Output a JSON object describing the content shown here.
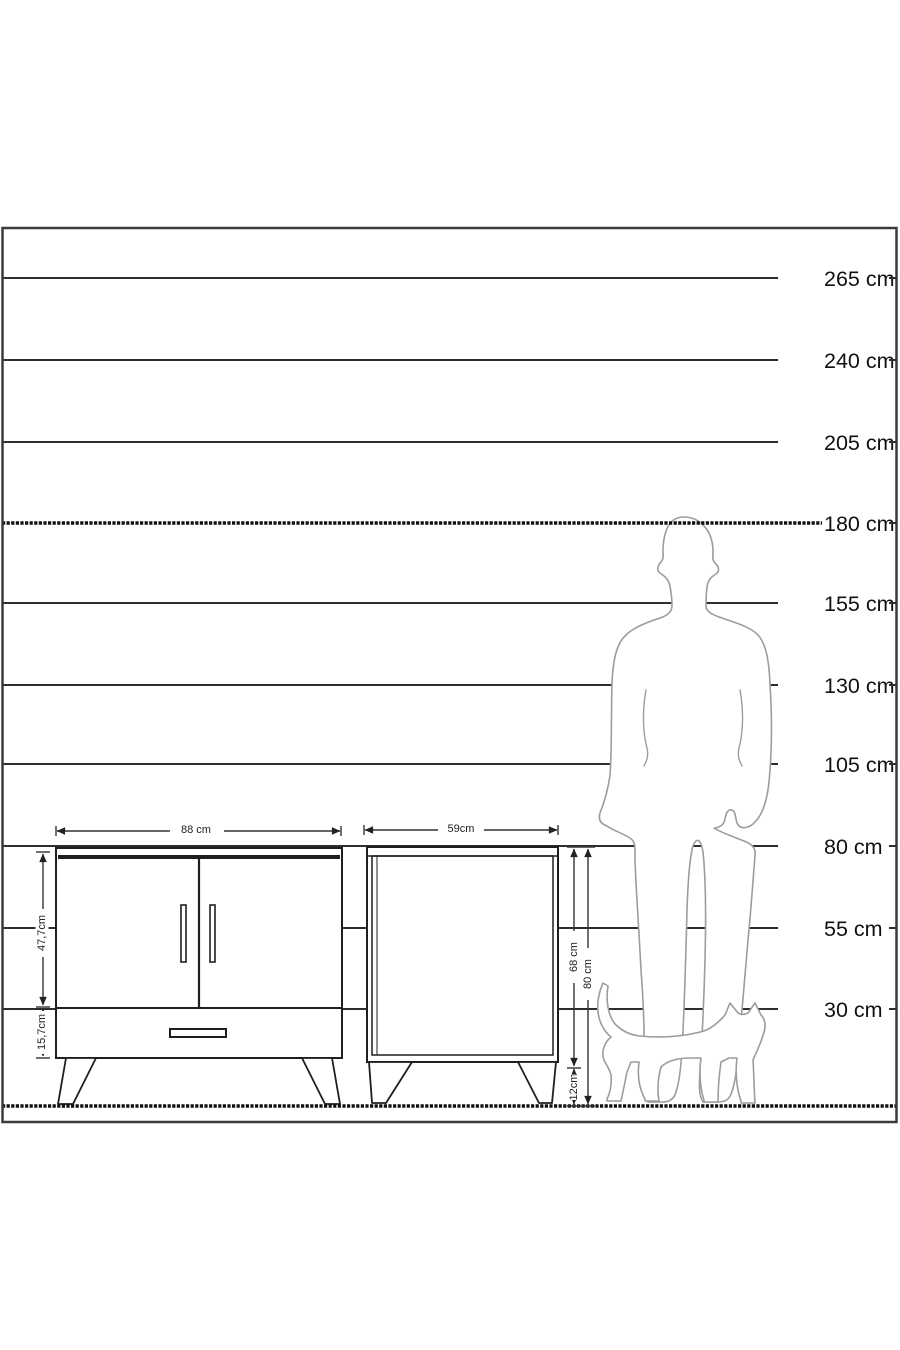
{
  "page": {
    "background": "#ffffff",
    "description": "furniture dimension diagram with wall height scale, sideboard, nightstand, man and cat silhouettes"
  },
  "scale": {
    "unit": "cm",
    "marks": [
      {
        "label": "265 cm",
        "value": 265,
        "y": 278,
        "style": "solid"
      },
      {
        "label": "240 cm",
        "value": 240,
        "y": 360,
        "style": "solid"
      },
      {
        "label": "205 cm",
        "value": 205,
        "y": 442,
        "style": "solid"
      },
      {
        "label": "180 cm",
        "value": 180,
        "y": 523,
        "style": "hatched"
      },
      {
        "label": "155 cm",
        "value": 155,
        "y": 603,
        "style": "solid"
      },
      {
        "label": "130 cm",
        "value": 130,
        "y": 685,
        "style": "solid"
      },
      {
        "label": "105 cm",
        "value": 105,
        "y": 764,
        "style": "solid"
      },
      {
        "label": "80 cm",
        "value": 80,
        "y": 846,
        "style": "solid"
      },
      {
        "label": "55 cm",
        "value": 55,
        "y": 928,
        "style": "solid"
      },
      {
        "label": "30 cm",
        "value": 30,
        "y": 1009,
        "style": "solid"
      }
    ],
    "ground": {
      "y": 1106,
      "style": "hatched"
    }
  },
  "dimensions": {
    "cabinet_width": "88 cm",
    "cabinet_door_height": "47,7cm",
    "cabinet_drawer_height": "15,7cm",
    "nightstand_width": "59cm",
    "nightstand_body_height": "68 cm",
    "nightstand_total_height": "80 cm",
    "nightstand_leg_height": "12cm"
  },
  "figures": {
    "man": "standing man silhouette (head at 180 cm line)",
    "cat": "walking cat silhouette"
  },
  "colors": {
    "line": "#2e2e2e",
    "text": "#111111",
    "silhouette_outline": "#9c9c9c",
    "dimension_line": "#333333",
    "background": "#ffffff"
  }
}
